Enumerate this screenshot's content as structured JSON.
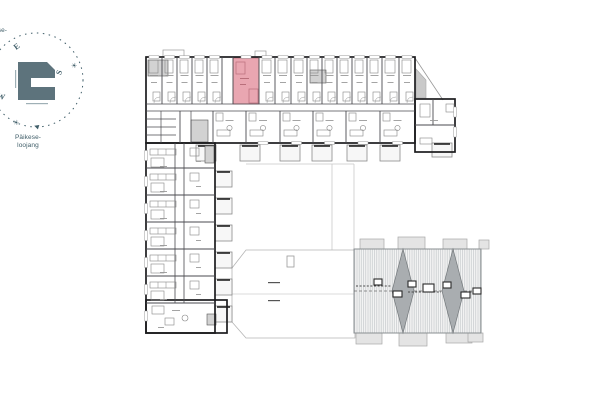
{
  "colors": {
    "wall": "#1c1c1e",
    "thin": "#4a4a4f",
    "light": "#9a9a9a",
    "faint": "#c9c9c9",
    "highlight": "#e9a6b1",
    "highlightLine": "#b96f7b",
    "core": "#d2d2d2",
    "balconyFill": "#f7f7f7",
    "tabFill": "#e4e4e4",
    "roofFill": "#f4f4f4",
    "roofHatch": "#c3c7ca",
    "roofEdge": "#8a8f92",
    "diamond": "#a9adb0",
    "diamondEdge": "#74797c",
    "teal": "#3f5d68",
    "logo": "#5d737c"
  },
  "compass": {
    "circle": {
      "cx": 36,
      "cy": 80,
      "r": 47,
      "dash": "1.5 4.5"
    },
    "letters": [
      {
        "id": "e",
        "t": "E",
        "x": 14,
        "y": 42,
        "r": -38
      },
      {
        "id": "s",
        "t": "S",
        "x": 57,
        "y": 68,
        "r": -72
      },
      {
        "id": "w",
        "t": "W",
        "x": -3,
        "y": 92,
        "r": 15
      }
    ],
    "suns": [
      {
        "id": "sunrise-sun",
        "t": "☀",
        "x": 71,
        "y": 63
      },
      {
        "id": "sunset-sun",
        "t": "☀",
        "x": 13,
        "y": 120
      }
    ],
    "arrow": {
      "t": "◀",
      "x": 34,
      "y": 124,
      "r": 18
    },
    "logo": {
      "path": "M18,62 L47,62 L55,70 L55,78 L31,78 L31,87 L55,87 L55,100 L18,100 Z",
      "side_mark": [
        15,
        70,
        1.2,
        18
      ],
      "bottom_mark": [
        26,
        103,
        22,
        1.2
      ]
    },
    "sunset_line1": "Päikese-",
    "sunset_line2": "loojang",
    "sunrise_line1": "Päikese-",
    "sunrise_line2": "tõus"
  },
  "plan": {
    "outlineRects": [
      [
        146,
        57,
        269,
        86
      ],
      [
        415,
        99,
        40,
        53
      ],
      [
        146,
        143,
        69,
        190
      ],
      [
        146,
        300,
        81,
        33
      ]
    ],
    "corridorLines": [
      [
        146,
        104,
        415,
        104
      ],
      [
        146,
        111,
        415,
        111
      ],
      [
        175,
        143,
        175,
        303
      ],
      [
        184,
        143,
        184,
        303
      ]
    ],
    "upperPartX": [
      162,
      177,
      192,
      207,
      222,
      233,
      259,
      275,
      291,
      307,
      322,
      337,
      352,
      367,
      382,
      399
    ],
    "upperY": [
      57,
      104
    ],
    "lowerPartX": [
      180,
      213,
      246,
      280,
      313,
      346,
      380
    ],
    "lowerY": [
      111,
      143
    ],
    "extLines": [
      [
        415,
        125,
        455,
        125
      ],
      [
        433,
        99,
        433,
        125
      ]
    ],
    "leftPartY": [
      168,
      195,
      222,
      249,
      276,
      303
    ],
    "leftX": [
      146,
      215
    ],
    "storage": {
      "vlines": [
        [
          161,
          111,
          161,
          143
        ],
        [
          191,
          111,
          191,
          143
        ]
      ],
      "hlines": [
        [
          146,
          119,
          176,
          119
        ],
        [
          146,
          127,
          176,
          127
        ],
        [
          146,
          135,
          176,
          135
        ]
      ]
    },
    "cores": [
      [
        191,
        120,
        17,
        22
      ],
      [
        310,
        70,
        16,
        13
      ],
      [
        205,
        146,
        9,
        17
      ],
      [
        207,
        314,
        9,
        11
      ],
      [
        148,
        60,
        20,
        16
      ]
    ],
    "highlight": {
      "rect": [
        233,
        58,
        26,
        46
      ],
      "innerRects": [
        [
          249,
          89,
          9,
          14
        ],
        [
          236,
          62,
          9,
          12
        ]
      ],
      "dashes": [
        [
          240,
          78,
          9
        ],
        [
          240,
          84,
          6
        ]
      ]
    },
    "balconiesSouth": [
      [
        196,
        145,
        20,
        16
      ],
      [
        240,
        145,
        20,
        16
      ],
      [
        280,
        145,
        20,
        16
      ],
      [
        312,
        145,
        20,
        16
      ],
      [
        347,
        145,
        20,
        16
      ],
      [
        380,
        145,
        20,
        16
      ],
      [
        432,
        143,
        20,
        14
      ]
    ],
    "balconiesEast": {
      "x": 215,
      "w": 17,
      "h": 16,
      "ys": [
        171,
        198,
        225,
        252,
        279,
        306
      ]
    },
    "topTabs": [
      [
        163,
        50,
        21,
        7
      ],
      [
        255,
        51,
        11,
        6
      ]
    ],
    "slantLine": [
      415,
      58,
      443,
      100
    ],
    "grayQuad": "416,69 426,80 426,98 416,98",
    "courtyardLines": [
      [
        246,
        164,
        354,
        164
      ],
      [
        332,
        164,
        332,
        250
      ],
      [
        354,
        164,
        354,
        250
      ]
    ]
  },
  "canopy": {
    "poly": "232,268 246,250 355,250 355,338 246,338 232,322",
    "innerLines": [
      [
        232,
        294,
        355,
        294
      ]
    ],
    "rooflight": [
      287,
      256,
      7,
      11
    ],
    "dashes": [
      [
        268,
        282,
        12
      ],
      [
        268,
        300,
        12
      ]
    ]
  },
  "roof": {
    "rect": [
      354,
      249,
      127,
      84
    ],
    "hatchSpacing": 2.2,
    "diamondCx": [
      403,
      453
    ],
    "diamondHw": 11,
    "ridgeY": 291,
    "hatches": [
      [
        374,
        279,
        8,
        6
      ],
      [
        393,
        291,
        9,
        6
      ],
      [
        408,
        281,
        8,
        6
      ],
      [
        423,
        284,
        11,
        8
      ],
      [
        443,
        282,
        8,
        6
      ],
      [
        461,
        292,
        9,
        6
      ],
      [
        473,
        288,
        8,
        6
      ]
    ],
    "rails": [
      [
        356,
        286,
        391,
        286
      ],
      [
        408,
        292,
        441,
        292
      ],
      [
        466,
        292,
        479,
        292
      ]
    ],
    "tabsTop": [
      [
        360,
        239,
        24,
        10
      ],
      [
        398,
        237,
        27,
        12
      ],
      [
        443,
        239,
        24,
        10
      ],
      [
        479,
        240,
        10,
        9
      ]
    ],
    "tabsBottom": [
      [
        356,
        333,
        26,
        11
      ],
      [
        399,
        333,
        28,
        13
      ],
      [
        446,
        333,
        26,
        10
      ],
      [
        468,
        333,
        15,
        9
      ]
    ]
  }
}
